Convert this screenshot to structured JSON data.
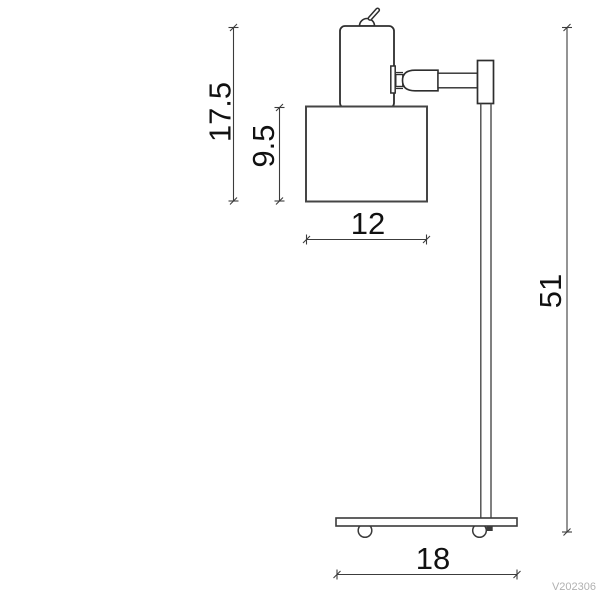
{
  "diagram": {
    "type": "technical-dimension-drawing",
    "subject": "desk lamp side elevation with dimensions",
    "units_shown": false,
    "dimensions": {
      "head_assembly_height": "17.5",
      "shade_height": "9.5",
      "shade_width": "12",
      "overall_pole_height": "51",
      "base_width": "18"
    },
    "watermark": "V202306",
    "colors": {
      "background": "#ffffff",
      "outline": "#2e2e2e",
      "shade_outline": "#454545",
      "dimension_line": "#3c3c3c",
      "dimension_text": "#111111",
      "watermark": "#b1b1b1"
    }
  }
}
